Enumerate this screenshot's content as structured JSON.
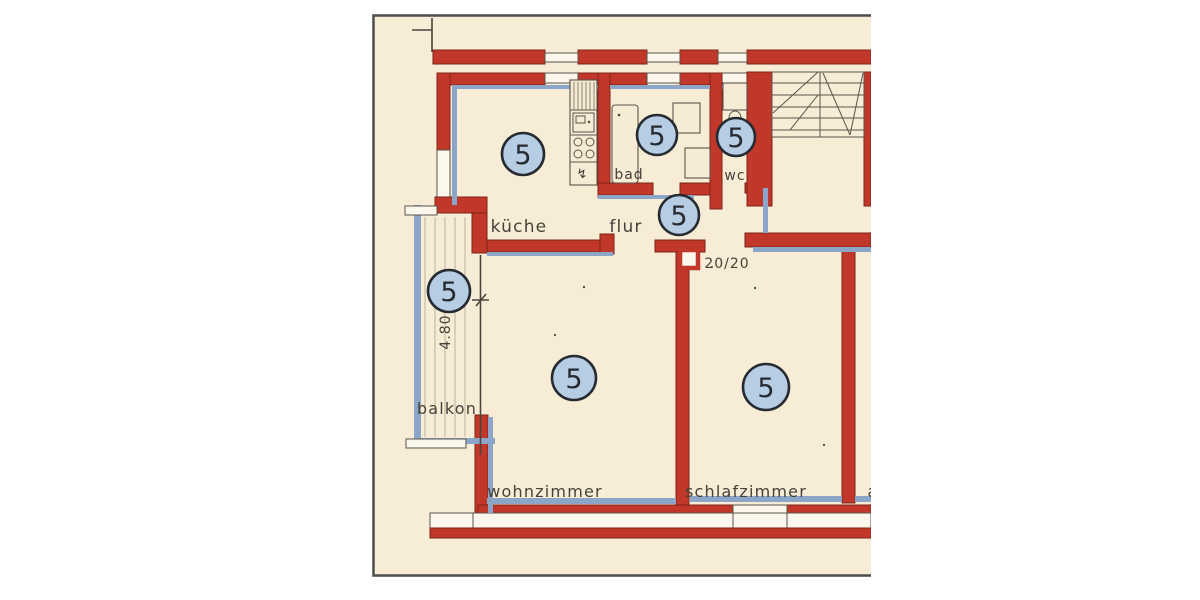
{
  "plan": {
    "type": "apartment-floor-plan",
    "rooms": {
      "kueche": {
        "label": "küche",
        "marker": "5"
      },
      "bad": {
        "label": "bad",
        "marker": "5"
      },
      "wc": {
        "label": "wc",
        "marker": "5"
      },
      "flur": {
        "label": "flur",
        "marker": "5"
      },
      "balkon": {
        "label": "balkon",
        "marker": "5"
      },
      "wohnzimmer": {
        "label": "wohnzimmer",
        "marker": "5"
      },
      "schlafzimmer": {
        "label": "schlafzimmer",
        "marker": "5"
      },
      "partial_room": {
        "label": "a"
      }
    },
    "annotations": {
      "door_dimension": "20/20",
      "balcony_dimension": "4.80"
    },
    "fixtures": {
      "gas_symbol": "↯"
    },
    "colors": {
      "paper": "#f7edd6",
      "wall_red": "#c1372a",
      "wall_outline": "#7e2417",
      "plaster_blue": "#8ba6c9",
      "marker_fill": "#b7cde3",
      "marker_stroke": "#262a31",
      "ink": "#46423a",
      "frame": "#4f4f4f"
    }
  }
}
